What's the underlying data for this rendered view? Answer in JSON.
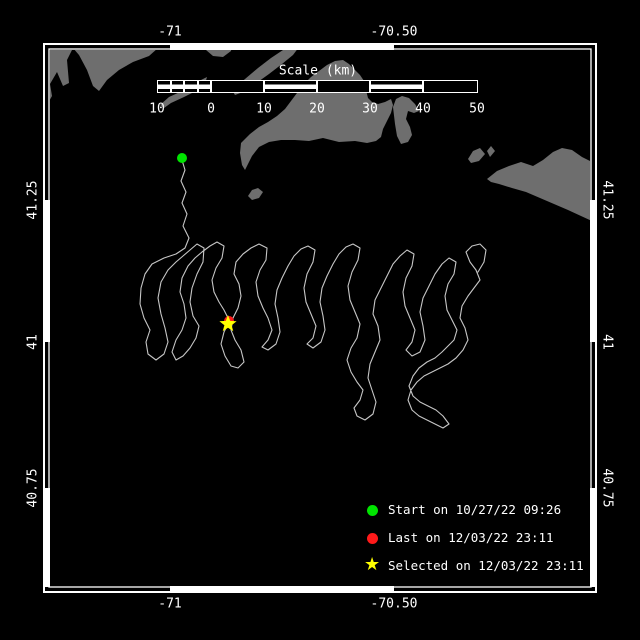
{
  "colors": {
    "background": "#000000",
    "land": "#6e6e6e",
    "track": "#c6c6c6",
    "frame": "#ffffff",
    "text": "#ffffff",
    "start_green": "#00e400",
    "last_red": "#ff1a1a",
    "selected_yellow": "#ffff00"
  },
  "frame": {
    "outer": [
      44,
      44,
      596,
      592
    ],
    "inner": [
      49,
      49,
      591,
      587
    ],
    "lon_ticks_x": [
      170,
      394
    ],
    "lat_ticks_y": [
      200,
      342,
      488
    ]
  },
  "axis_labels": {
    "top": [
      "-71",
      "-70.50"
    ],
    "bottom": [
      "-71",
      "-70.50"
    ],
    "left": [
      "41.25",
      "41",
      "40.75"
    ],
    "right": [
      "41.25",
      "41",
      "40.75"
    ]
  },
  "scalebar": {
    "title": "Scale (km)",
    "title_center": [
      318,
      71
    ],
    "bar_y": 80,
    "bar_h": 13,
    "labels_y": 109,
    "cells": [
      {
        "x": 157.0,
        "w": 13.5,
        "striped": true
      },
      {
        "x": 170.5,
        "w": 13.5,
        "striped": true
      },
      {
        "x": 184.0,
        "w": 13.5,
        "striped": true
      },
      {
        "x": 197.5,
        "w": 13.5,
        "striped": true
      },
      {
        "x": 211.0,
        "w": 53.0,
        "striped": false
      },
      {
        "x": 264.0,
        "w": 53.0,
        "striped": true
      },
      {
        "x": 317.0,
        "w": 53.0,
        "striped": false
      },
      {
        "x": 370.0,
        "w": 53.0,
        "striped": true
      },
      {
        "x": 423.0,
        "w": 55.0,
        "striped": false
      }
    ],
    "tick_labels": [
      {
        "text": "10",
        "x": 157
      },
      {
        "text": "0",
        "x": 211
      },
      {
        "text": "10",
        "x": 264
      },
      {
        "text": "20",
        "x": 317
      },
      {
        "text": "30",
        "x": 370
      },
      {
        "text": "40",
        "x": 423
      },
      {
        "text": "50",
        "x": 477
      }
    ]
  },
  "legend": {
    "marker_x": 367,
    "items": [
      {
        "key": "start",
        "marker": "circle",
        "color": "#00e400",
        "label": "Start on 10/27/22 09:26",
        "y": 510
      },
      {
        "key": "last",
        "marker": "circle",
        "color": "#ff1a1a",
        "label": "Last on 12/03/22 23:11",
        "y": 538
      },
      {
        "key": "selected",
        "marker": "star",
        "color": "#ffff00",
        "label": "Selected on 12/03/22 23:11",
        "y": 566
      }
    ]
  },
  "markers": {
    "start": {
      "x": 182,
      "y": 158,
      "r": 5,
      "color": "#00e400"
    },
    "last": {
      "x": 229,
      "y": 321,
      "r": 5,
      "color": "#ff1a1a"
    },
    "selected": {
      "x": 228,
      "y": 324,
      "r": 9,
      "color": "#ffff00"
    }
  },
  "land": [
    {
      "name": "mainland-northwest",
      "points": "44,110 52,96 50,84 57,72 63,86 69,83 67,60 73,48 79,55 87,70 93,86 99,91 107,80 119,70 133,62 149,56 158,48 160,44 44,44"
    },
    {
      "name": "falmouth-shore",
      "points": "206,44 232,44 231,51 223,57 213,56 206,50"
    },
    {
      "name": "elizabeth-islands-outer",
      "points": "232,90 245,79 258,68 271,58 283,50 294,45 299,47 293,55 282,64 269,74 255,84 243,92 235,95"
    },
    {
      "name": "elizabeth-islands-inner",
      "points": "160,105 169,97 180,92 191,85 201,80 207,77 205,84 196,91 184,97 171,103 164,108"
    },
    {
      "name": "marthas-vineyard",
      "points": "241,143 250,134 259,127 268,122 277,116 285,109 291,101 297,93 303,85 311,77 319,71 327,65 335,61 343,60 349,64 355,70 360,75 364,81 366,90 368,98 372,102 378,104 385,102 391,99 393,105 391,113 387,121 383,129 381,137 376,141 367,143 355,141 339,142 323,138 309,141 295,140 281,140 269,142 259,147 252,156 248,164 245,170 242,165 240,153"
    },
    {
      "name": "chappaquiddick-hook",
      "points": "393,107 396,99 402,96 409,98 415,104 419,111 414,113 408,111 406,119 410,127 412,135 408,142 401,144 397,136 395,124"
    },
    {
      "name": "nomans-land-island",
      "points": "248,196 252,190 258,188 263,192 259,198 252,200"
    },
    {
      "name": "tuckernuck-island",
      "points": "468,159 473,151 480,148 485,154 479,161 471,163"
    },
    {
      "name": "muskeget-island",
      "points": "487,151 491,146 495,151 490,157"
    },
    {
      "name": "nantucket",
      "points": "487,179 497,171 509,166 521,162 533,166 543,160 553,152 562,148 572,150 582,157 592,162 592,221 581,216 568,210 554,204 540,198 526,192 512,188 499,184 491,182"
    }
  ],
  "track": [
    [
      182,
      160
    ],
    [
      185,
      170
    ],
    [
      181,
      181
    ],
    [
      186,
      192
    ],
    [
      182,
      203
    ],
    [
      187,
      214
    ],
    [
      183,
      226
    ],
    [
      189,
      238
    ],
    [
      185,
      248
    ],
    [
      176,
      254
    ],
    [
      164,
      258
    ],
    [
      152,
      264
    ],
    [
      145,
      274
    ],
    [
      141,
      288
    ],
    [
      140,
      304
    ],
    [
      144,
      318
    ],
    [
      150,
      330
    ],
    [
      146,
      342
    ],
    [
      148,
      354
    ],
    [
      156,
      360
    ],
    [
      164,
      354
    ],
    [
      168,
      342
    ],
    [
      165,
      328
    ],
    [
      161,
      314
    ],
    [
      158,
      298
    ],
    [
      161,
      282
    ],
    [
      168,
      270
    ],
    [
      176,
      262
    ],
    [
      183,
      256
    ],
    [
      190,
      250
    ],
    [
      197,
      244
    ],
    [
      204,
      248
    ],
    [
      203,
      262
    ],
    [
      197,
      274
    ],
    [
      192,
      288
    ],
    [
      190,
      302
    ],
    [
      193,
      316
    ],
    [
      199,
      326
    ],
    [
      196,
      338
    ],
    [
      190,
      348
    ],
    [
      183,
      356
    ],
    [
      176,
      360
    ],
    [
      172,
      352
    ],
    [
      176,
      340
    ],
    [
      182,
      330
    ],
    [
      186,
      318
    ],
    [
      184,
      304
    ],
    [
      180,
      292
    ],
    [
      182,
      278
    ],
    [
      188,
      266
    ],
    [
      195,
      258
    ],
    [
      202,
      252
    ],
    [
      210,
      246
    ],
    [
      217,
      242
    ],
    [
      224,
      246
    ],
    [
      222,
      258
    ],
    [
      216,
      268
    ],
    [
      212,
      280
    ],
    [
      214,
      292
    ],
    [
      219,
      302
    ],
    [
      224,
      310
    ],
    [
      228,
      318
    ],
    [
      228,
      324
    ],
    [
      224,
      332
    ],
    [
      221,
      344
    ],
    [
      225,
      356
    ],
    [
      231,
      366
    ],
    [
      238,
      368
    ],
    [
      244,
      362
    ],
    [
      241,
      350
    ],
    [
      235,
      340
    ],
    [
      231,
      330
    ],
    [
      233,
      318
    ],
    [
      238,
      308
    ],
    [
      241,
      296
    ],
    [
      239,
      284
    ],
    [
      234,
      274
    ],
    [
      236,
      262
    ],
    [
      243,
      254
    ],
    [
      251,
      248
    ],
    [
      259,
      244
    ],
    [
      267,
      248
    ],
    [
      266,
      260
    ],
    [
      260,
      270
    ],
    [
      256,
      282
    ],
    [
      258,
      296
    ],
    [
      263,
      308
    ],
    [
      268,
      318
    ],
    [
      272,
      330
    ],
    [
      268,
      340
    ],
    [
      262,
      347
    ],
    [
      268,
      350
    ],
    [
      276,
      344
    ],
    [
      280,
      332
    ],
    [
      278,
      318
    ],
    [
      275,
      304
    ],
    [
      277,
      290
    ],
    [
      282,
      278
    ],
    [
      288,
      266
    ],
    [
      294,
      256
    ],
    [
      301,
      249
    ],
    [
      308,
      246
    ],
    [
      315,
      250
    ],
    [
      313,
      262
    ],
    [
      307,
      274
    ],
    [
      304,
      288
    ],
    [
      306,
      302
    ],
    [
      311,
      314
    ],
    [
      316,
      326
    ],
    [
      313,
      338
    ],
    [
      307,
      344
    ],
    [
      313,
      348
    ],
    [
      321,
      342
    ],
    [
      325,
      330
    ],
    [
      323,
      316
    ],
    [
      320,
      302
    ],
    [
      322,
      288
    ],
    [
      327,
      276
    ],
    [
      333,
      264
    ],
    [
      339,
      254
    ],
    [
      346,
      247
    ],
    [
      353,
      244
    ],
    [
      360,
      248
    ],
    [
      358,
      260
    ],
    [
      352,
      272
    ],
    [
      348,
      286
    ],
    [
      350,
      300
    ],
    [
      355,
      312
    ],
    [
      360,
      324
    ],
    [
      357,
      338
    ],
    [
      351,
      348
    ],
    [
      347,
      360
    ],
    [
      351,
      372
    ],
    [
      357,
      382
    ],
    [
      363,
      390
    ],
    [
      360,
      400
    ],
    [
      354,
      408
    ],
    [
      357,
      416
    ],
    [
      365,
      420
    ],
    [
      373,
      414
    ],
    [
      376,
      402
    ],
    [
      372,
      390
    ],
    [
      368,
      378
    ],
    [
      370,
      364
    ],
    [
      375,
      352
    ],
    [
      380,
      340
    ],
    [
      378,
      326
    ],
    [
      373,
      314
    ],
    [
      375,
      300
    ],
    [
      381,
      288
    ],
    [
      387,
      276
    ],
    [
      393,
      264
    ],
    [
      400,
      256
    ],
    [
      407,
      250
    ],
    [
      414,
      254
    ],
    [
      412,
      266
    ],
    [
      406,
      278
    ],
    [
      403,
      292
    ],
    [
      405,
      306
    ],
    [
      410,
      318
    ],
    [
      415,
      330
    ],
    [
      412,
      342
    ],
    [
      406,
      350
    ],
    [
      412,
      356
    ],
    [
      420,
      352
    ],
    [
      425,
      340
    ],
    [
      423,
      326
    ],
    [
      420,
      312
    ],
    [
      423,
      298
    ],
    [
      429,
      286
    ],
    [
      435,
      274
    ],
    [
      442,
      264
    ],
    [
      449,
      258
    ],
    [
      456,
      262
    ],
    [
      454,
      274
    ],
    [
      448,
      284
    ],
    [
      445,
      296
    ],
    [
      447,
      310
    ],
    [
      452,
      320
    ],
    [
      457,
      330
    ],
    [
      454,
      340
    ],
    [
      448,
      346
    ],
    [
      442,
      352
    ],
    [
      435,
      358
    ],
    [
      427,
      362
    ],
    [
      419,
      368
    ],
    [
      413,
      376
    ],
    [
      409,
      386
    ],
    [
      413,
      396
    ],
    [
      420,
      402
    ],
    [
      428,
      406
    ],
    [
      436,
      410
    ],
    [
      443,
      416
    ],
    [
      449,
      424
    ],
    [
      443,
      428
    ],
    [
      435,
      424
    ],
    [
      427,
      420
    ],
    [
      419,
      416
    ],
    [
      412,
      410
    ],
    [
      408,
      400
    ],
    [
      411,
      390
    ],
    [
      417,
      382
    ],
    [
      424,
      376
    ],
    [
      432,
      372
    ],
    [
      440,
      368
    ],
    [
      448,
      364
    ],
    [
      456,
      358
    ],
    [
      463,
      350
    ],
    [
      468,
      340
    ],
    [
      465,
      328
    ],
    [
      460,
      318
    ],
    [
      462,
      306
    ],
    [
      468,
      296
    ],
    [
      474,
      288
    ],
    [
      480,
      280
    ],
    [
      476,
      270
    ],
    [
      470,
      262
    ],
    [
      466,
      252
    ],
    [
      472,
      246
    ],
    [
      480,
      244
    ],
    [
      486,
      250
    ],
    [
      484,
      262
    ],
    [
      478,
      272
    ]
  ]
}
